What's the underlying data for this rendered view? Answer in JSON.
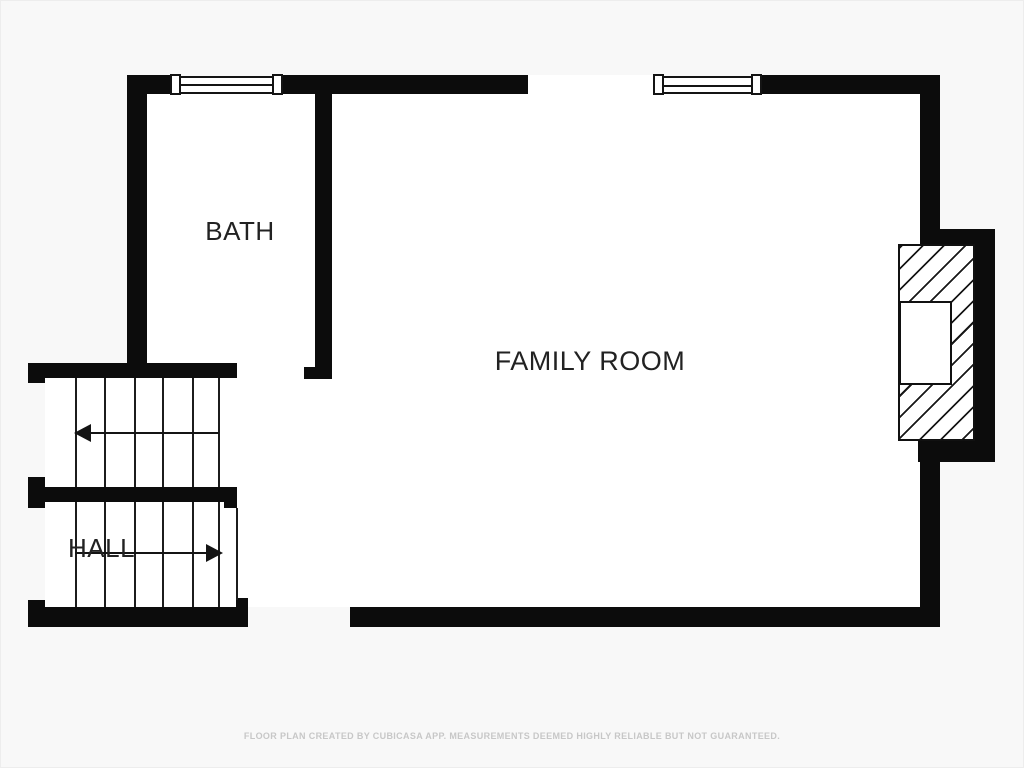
{
  "floor_plan": {
    "rooms": [
      {
        "id": "bath",
        "label": "BATH"
      },
      {
        "id": "family_room",
        "label": "FAMILY ROOM"
      },
      {
        "id": "hall",
        "label": "HALL"
      }
    ],
    "stairs": {
      "upper_run_arrow": "arrow-left",
      "lower_run_arrow": "arrow-right",
      "upper_run_treads": 6,
      "lower_run_treads": 6
    },
    "features": [
      {
        "id": "fireplace",
        "style": "diagonal-hatch"
      },
      {
        "id": "window_1",
        "location": "top-wall-over-bath"
      },
      {
        "id": "window_2",
        "location": "top-wall-over-family-room"
      }
    ],
    "colors": {
      "wall": "#0c0c0c",
      "background": "#f8f8f8",
      "room_fill": "#ffffff",
      "tread_line": "#1c1c1c",
      "label_text": "#222222",
      "footer_text": "#c7c7c7"
    },
    "footer": {
      "disclaimer": "FLOOR PLAN CREATED BY CUBICASA APP. MEASUREMENTS DEEMED HIGHLY RELIABLE BUT NOT GUARANTEED."
    }
  }
}
